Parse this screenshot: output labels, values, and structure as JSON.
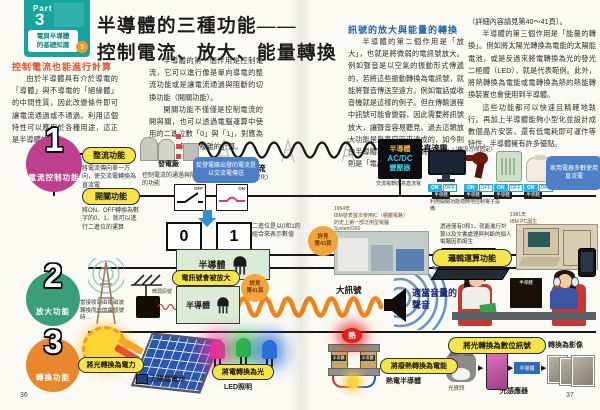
{
  "page": {
    "left_no": "36",
    "right_no": "37"
  },
  "cover": {
    "part": "Part",
    "part_no": "3",
    "series": "電與半導體\n的基礎知識",
    "corner": "3"
  },
  "title": {
    "line1": "半導體的三種功能——",
    "line2": "控制電流、放大、能量轉換"
  },
  "left_article": {
    "heading": "控制電流也能進行計算",
    "p1": "由於半導體具有介於導電的「導體」與不導電的「絕緣體」的中間性質，因此改變條件即可讓電流通過或不通過。利用這個特性可以應用於各種用途，這正是半導體的優勢。",
    "p2": "半導體的第一個作用是控制電流，它可以進行像是單向導電的整流功能或是讓電流通過與阻斷的切換功能（開關功能）。",
    "p3": "開關功能不僅僅是控制電流的開與關，也可以透過電腦運算中使用的二進位數「0」與「1」，對應為關與開，來實現複雜的計算。"
  },
  "right_article": {
    "heading": "訊號的放大與能量的轉換",
    "p1": "半導體的第二個作用是「放大」，也就是將微弱的電訊號放大。例如聲音是以空氣的振動形式傳遞的，若將這些振動轉換為電訊號，就能將聲音傳送至遠方。例如電話或收音機就是這樣的例子。但在傳輸過程中訊號可能會變弱，因此需要將訊號放大，讓聲音容易聽見。過去這類放大功能是靠真空管來達成的，如今則由半導體取而代之，負責訊號放大的則是「電晶體」",
    "p2": "（詳細內容請見第40～41頁）。",
    "p3": "半導體的第三個作用是「能量的轉換」。例如將太陽光轉換為電能的太陽能電池，或是反過來將電轉換為光的發光二極體（LED），就是代表範例。此外，將熱轉換為電能或電轉換為熱的熱能轉換裝置也會使用到半導體。",
    "p4": "這些功能都可以快速且精確地執行。再加上半導體能夠小型化並設計成數個晶片安裝，還有低電耗即可運作等特性，半導體擁有許多優點。"
  },
  "s1": {
    "no": "1",
    "label": "電流控制功能",
    "rect_pill": "整流功能",
    "rect_note": "將電流傳向單一方向，使交流電轉換為直流電",
    "plant": "發電廠",
    "ac_note": "從發電廠出發的電流是以交流電傳送",
    "ac_label": "AC交流電流",
    "ac_sub": "（電流方向會變化）",
    "conv1": "半導體",
    "conv2": "AC/DC",
    "conv3": "變壓器",
    "conv_note1": "交流電轉換為直流電",
    "conv_note2": "利用開關功能適時地控制電子設備",
    "dc_label": "DC直流電",
    "dc_sub": "（電流方向固定）",
    "on": "ON",
    "off": "OFF",
    "chip": "半導體",
    "home_note": "家用電器多數使用直流電",
    "switch_pill": "開關功能",
    "switch_note1": "控制電流的通過與阻斷的功能",
    "switch_note2": "將ON、OFF轉換為數字的0、1，就可以進行二進位的運算",
    "sw_off": "OFF",
    "sw_on": "ON",
    "bit0": "0",
    "bit1": "1",
    "binary_note": "二進位是以0和1的組合來表示數值",
    "semi": "半導體",
    "see_ref": "詳見\n第43頁",
    "ibm_caption": "1964年\nIBM發表首次使用IC（積體電路）\n的史上第一部泛用型電腦\nSystem/360",
    "pc_note": "透過僅有0和1，就能進行計算以及文書處理與判斷的個人電腦因而誕生",
    "logic_pill": "邏輯運算功能",
    "ibmpc": "1981年\nIBM PC誕生"
  },
  "s2": {
    "no": "2",
    "label": "放大功能",
    "receive_note": "當接收到由電磁波轉換而來的電訊號時…",
    "weak": "微弱訊號",
    "amp_pill": "電訊號會被放大",
    "semi": "半導體",
    "see_ref": "詳見\n第41頁",
    "big": "大訊號",
    "volume": "適當音量的\n聲音",
    "chip": "半導體"
  },
  "s3": {
    "no": "3",
    "label": "轉換功能",
    "solar_pill": "將光轉換為電力",
    "solar_label": "太陽能電池",
    "led_pill": "將電轉換為光",
    "led_label": "LED照明",
    "heat": "熱",
    "thermo_pill": "將廢熱轉換為電能",
    "thermo_label": "熱電半導體",
    "chip": "半導體",
    "photo_pill": "將光轉換為數位訊號",
    "image_label": "轉換為影像",
    "light_info": "光資訊",
    "sensor_label": "光感應器"
  }
}
